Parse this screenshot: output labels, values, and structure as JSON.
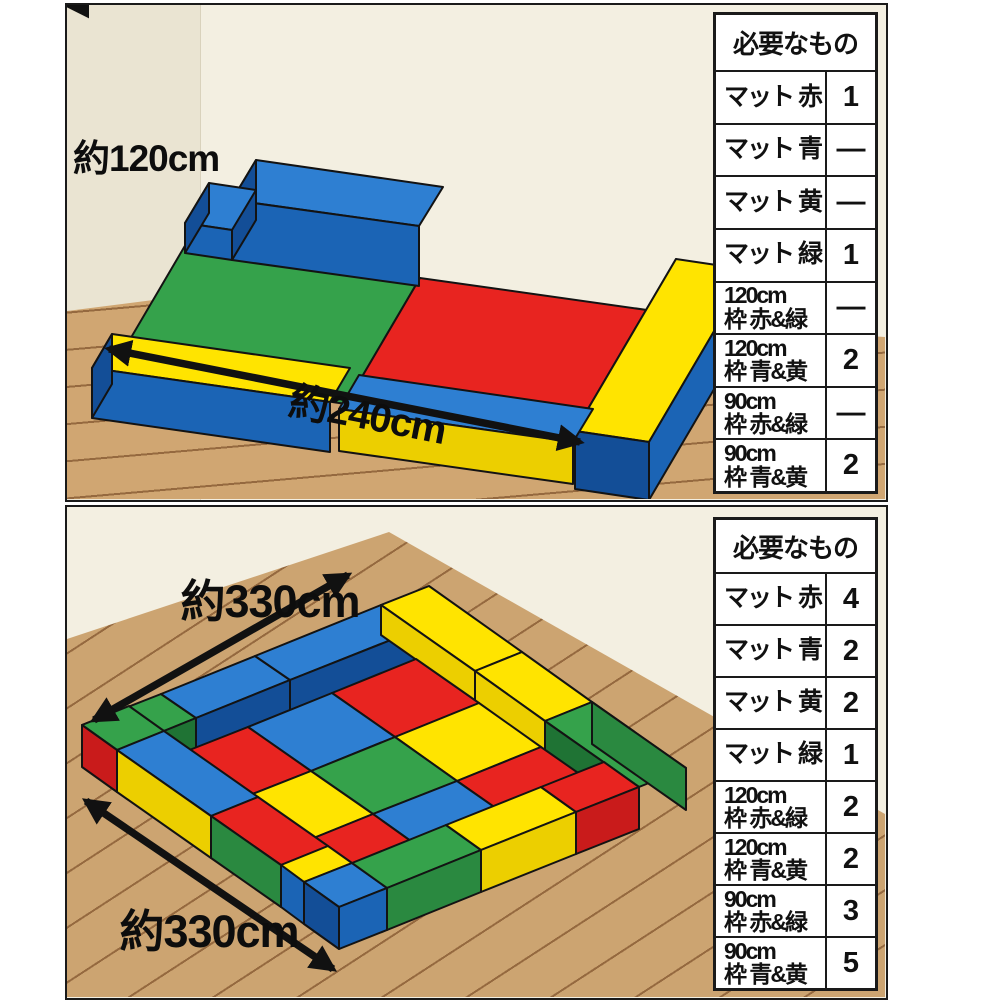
{
  "colors": {
    "red": "#e82420",
    "red_shade": "#c91b1b",
    "blue_top": "#2e7fd2",
    "blue": "#1b64b5",
    "blue_shade": "#134e97",
    "yellow": "#ffe400",
    "yellow_shade": "#eccf00",
    "green": "#35a24b",
    "green_shade": "#2a8940",
    "green_inner": "#1f7334",
    "floor_top_panel": "#d0a672",
    "floor_bottom_panel": "#cca471",
    "plank_line": "#95693f",
    "wall": "#f3efe1",
    "wall_left": "#eae4d2",
    "table_border": "#1a1a1a"
  },
  "panels": [
    {
      "name": "two-mat-layout",
      "dim_depth": "約120cm",
      "dim_length": "約240cm",
      "table": {
        "header": "必要なもの",
        "rows": [
          {
            "label": "マット 赤",
            "qty": "1"
          },
          {
            "label": "マット 青",
            "qty": "—"
          },
          {
            "label": "マット 黄",
            "qty": "—"
          },
          {
            "label": "マット 緑",
            "qty": "1"
          },
          {
            "label": "120cm\n枠 赤&緑",
            "qty": "—"
          },
          {
            "label": "120cm\n枠 青&黄",
            "qty": "2"
          },
          {
            "label": "90cm\n枠 赤&緑",
            "qty": "—"
          },
          {
            "label": "90cm\n枠 青&黄",
            "qty": "2"
          }
        ]
      }
    },
    {
      "name": "nine-mat-layout",
      "dim_side_a": "約330cm",
      "dim_side_b": "約330cm",
      "table": {
        "header": "必要なもの",
        "rows": [
          {
            "label": "マット 赤",
            "qty": "4"
          },
          {
            "label": "マット 青",
            "qty": "2"
          },
          {
            "label": "マット 黄",
            "qty": "2"
          },
          {
            "label": "マット 緑",
            "qty": "1"
          },
          {
            "label": "120cm\n枠 赤&緑",
            "qty": "2"
          },
          {
            "label": "120cm\n枠 青&黄",
            "qty": "2"
          },
          {
            "label": "90cm\n枠 赤&緑",
            "qty": "3"
          },
          {
            "label": "90cm\n枠 青&黄",
            "qty": "5"
          }
        ]
      }
    }
  ]
}
